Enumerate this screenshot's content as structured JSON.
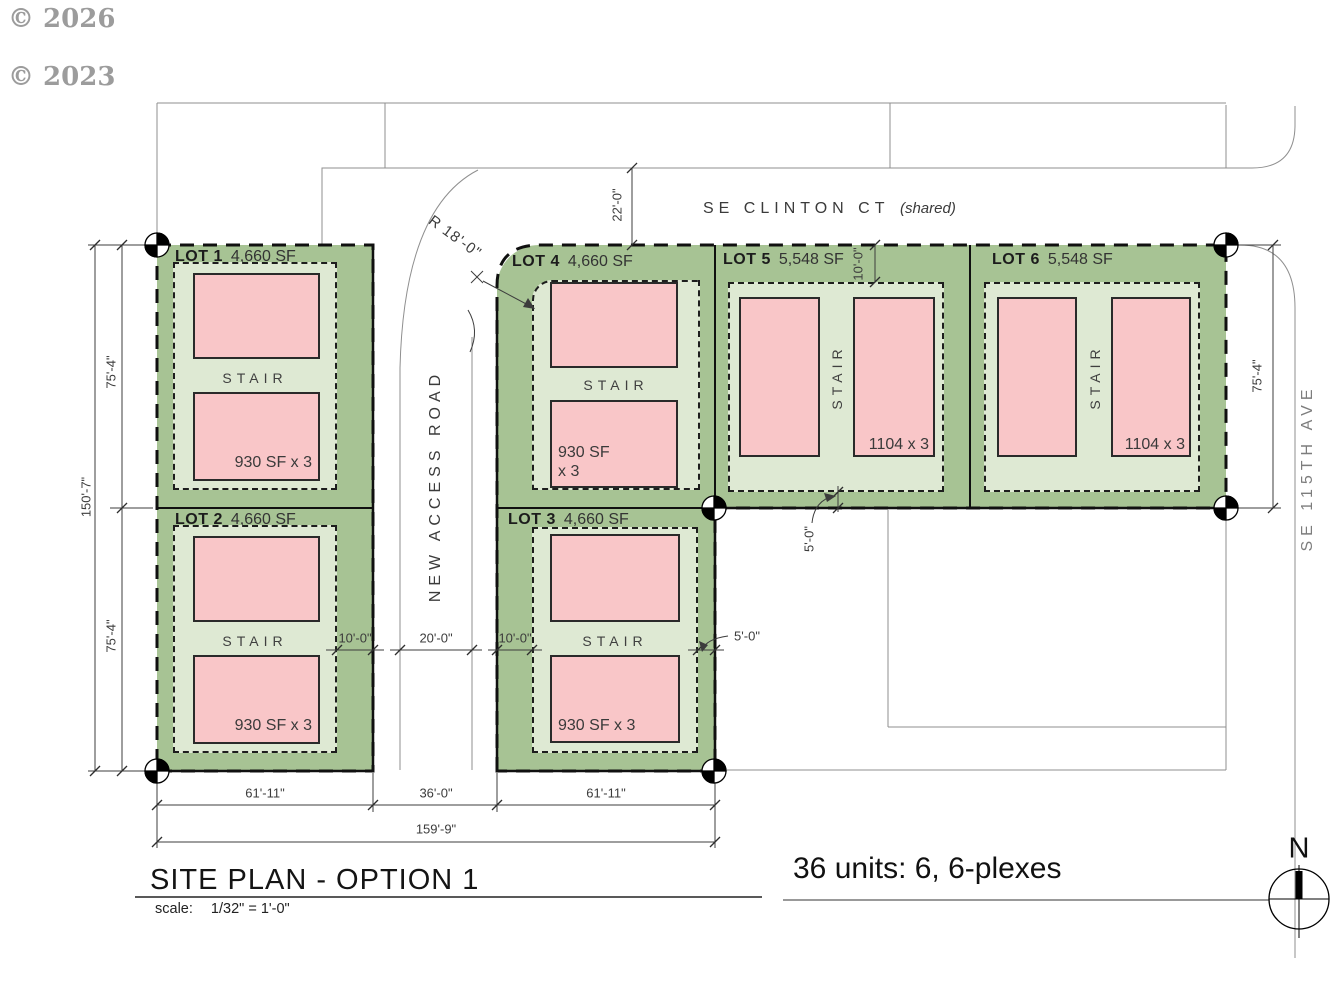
{
  "watermarks": {
    "first": "© 2026",
    "second": "© 2023"
  },
  "streets": {
    "clinton_name": "SE CLINTON CT",
    "clinton_suffix": "(shared)",
    "access_road": "NEW ACCESS ROAD",
    "ave_115th": "SE 115TH AVE"
  },
  "lots": [
    {
      "name": "LOT 1",
      "area": "4,660 SF",
      "stair": "STAIR",
      "unit": "930 SF x 3"
    },
    {
      "name": "LOT 2",
      "area": "4,660 SF",
      "stair": "STAIR",
      "unit": "930 SF x 3"
    },
    {
      "name": "LOT 3",
      "area": "4,660 SF",
      "stair": "STAIR",
      "unit": "930 SF x 3"
    },
    {
      "name": "LOT 4",
      "area": "4,660 SF",
      "stair": "STAIR",
      "unit": "930 SF\nx 3"
    },
    {
      "name": "LOT 5",
      "area": "5,548 SF",
      "stair": "STAIR",
      "unit": "1104 x 3"
    },
    {
      "name": "LOT 6",
      "area": "5,548 SF",
      "stair": "STAIR",
      "unit": "1104 x 3"
    }
  ],
  "dimensions": {
    "site_height": "150'-7\"",
    "lot_height_upper": "75'-4\"",
    "lot_height_lower": "75'-4\"",
    "lot_height_right": "75'-4\"",
    "bottom_left": "61'-11\"",
    "bottom_center": "36'-0\"",
    "bottom_right": "61'-11\"",
    "bottom_total": "159'-9\"",
    "street_width": "22'-0\"",
    "corner_radius": "R 18'-0\"",
    "setback_left_10": "10'-0\"",
    "road_width_20": "20'-0\"",
    "setback_right_10": "10'-0\"",
    "setback_lot5_10": "10'-0\"",
    "setback_lot3_5": "5'-0\"",
    "setback_lot5_5": "5'-0\""
  },
  "title_block": {
    "title": "SITE PLAN - OPTION 1",
    "scale_label": "scale:",
    "scale_value": "1/32\" = 1'-0\"",
    "units_summary": "36 units: 6, 6-plexes",
    "north_label": "N"
  },
  "colors": {
    "lot_green": "#a7c394",
    "setback_green": "#dee9d3",
    "building_pink": "#f9c6c8"
  }
}
